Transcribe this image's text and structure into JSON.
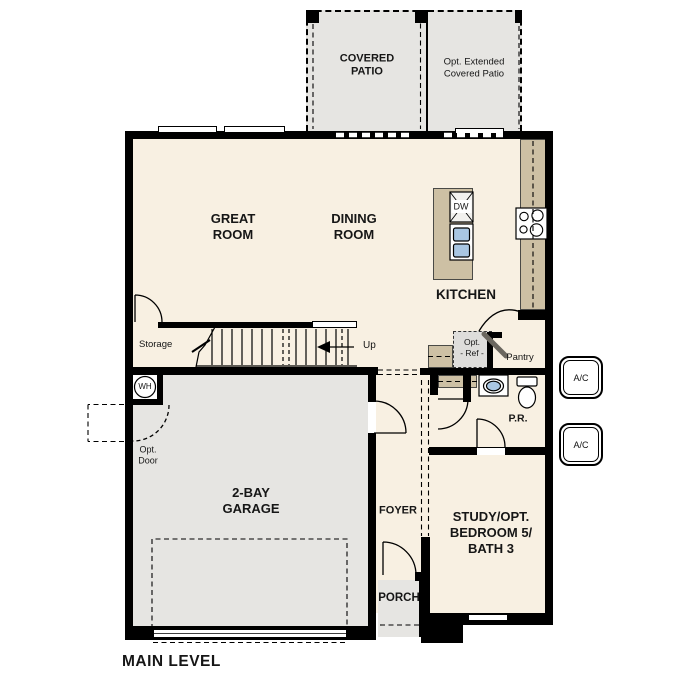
{
  "plan": {
    "labels": {
      "covered_patio": "COVERED PATIO",
      "opt_patio": "Opt. Extended Covered Patio",
      "great_room": "GREAT ROOM",
      "dining_room": "DINING ROOM",
      "kitchen": "KITCHEN",
      "storage": "Storage",
      "up": "Up",
      "dw": "DW",
      "wh": "WH",
      "opt_ref_line1": "Opt.",
      "opt_ref_line2": "- Ref -",
      "pantry": "Pantry",
      "powder_room": "P.R.",
      "ac": "A/C",
      "opt_door_line1": "Opt.",
      "opt_door_line2": "Door",
      "garage": "2-BAY GARAGE",
      "foyer": "FOYER",
      "porch": "PORCH",
      "study": "STUDY/OPT. BEDROOM 5/ BATH 3",
      "main_level": "MAIN LEVEL"
    },
    "colors": {
      "wall": "#000000",
      "interior_floor": "#f8f0e2",
      "garage_patio_floor": "#e6e5e2",
      "counter": "#cdc0a4",
      "fixture_blue": "#a9c6e2",
      "optional_item_fill": "#dedddb"
    }
  }
}
